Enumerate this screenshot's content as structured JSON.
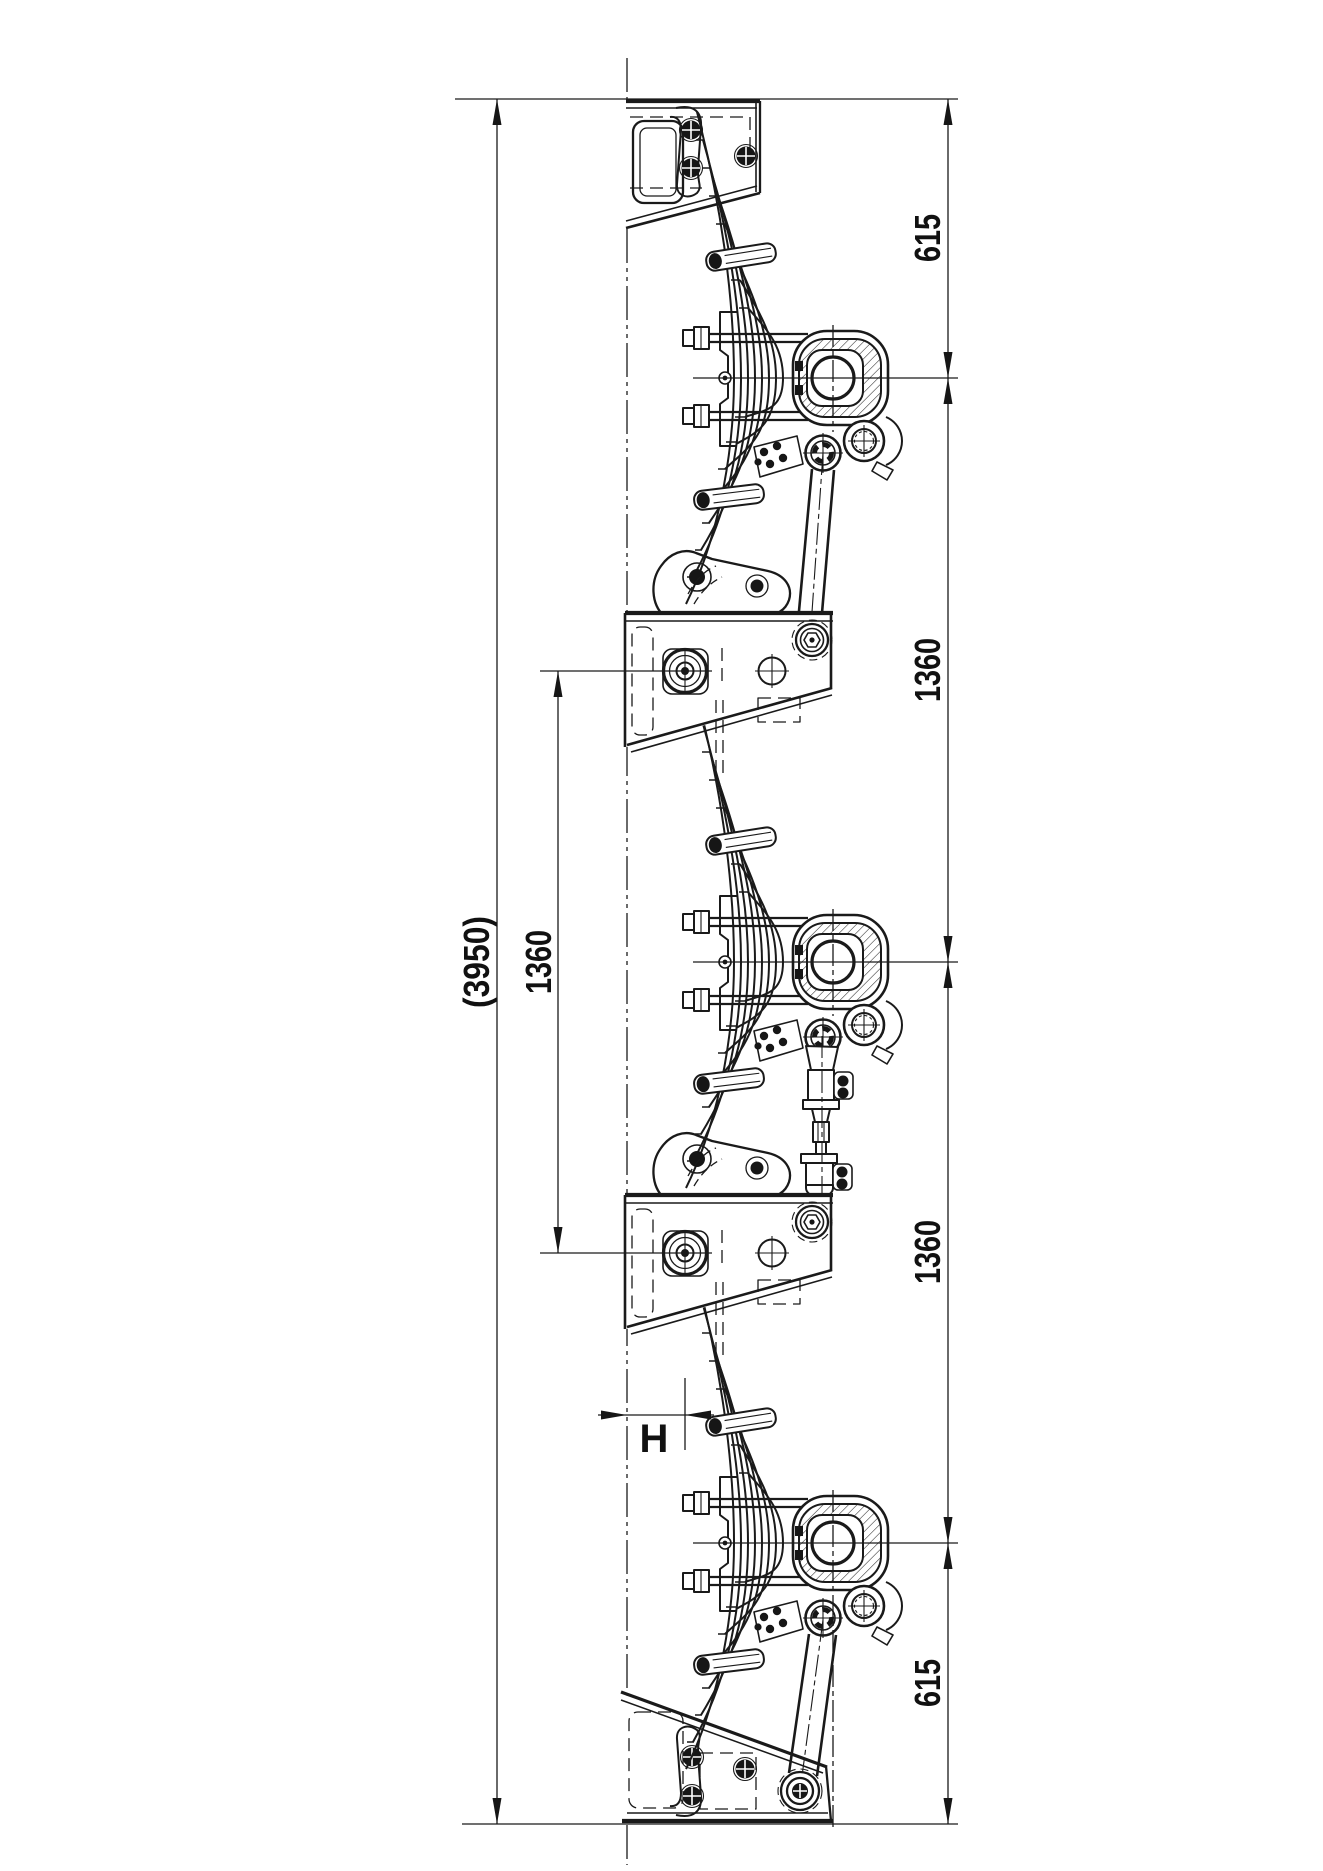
{
  "drawing": {
    "type": "engineering-drawing",
    "subject": "tri-axle leaf spring trailer suspension side view",
    "line_color": "#1a1a1a",
    "background": "#ffffff",
    "dimensions": {
      "overall_length": "(3950)",
      "equalizer_pin_spacing": "1360",
      "front_overhang": "615",
      "axle_spacing_front": "1360",
      "axle_spacing_rear": "1360",
      "rear_overhang": "615",
      "offset_reference": "H"
    }
  }
}
